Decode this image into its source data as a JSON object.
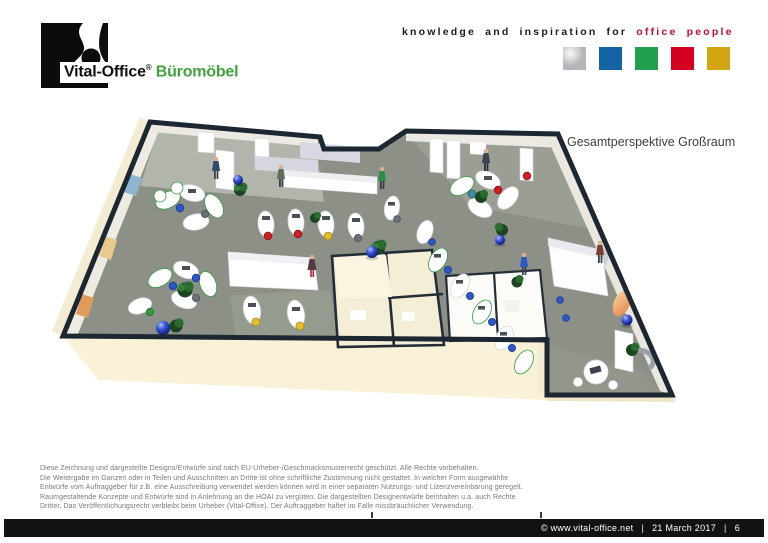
{
  "header": {
    "brand": {
      "name": "Vital-Office",
      "reg": "®",
      "product": "Büromöbel",
      "product_color": "#3fa43c"
    },
    "tagline": {
      "black": "knowledge and inspiration for",
      "red": "office people",
      "red_color": "#c30b2a"
    },
    "squares": [
      {
        "name": "silver",
        "color": "#b4b6b9"
      },
      {
        "name": "blue",
        "color": "#1464a5"
      },
      {
        "name": "green",
        "color": "#22a04d"
      },
      {
        "name": "red",
        "color": "#d60021"
      },
      {
        "name": "gold",
        "color": "#d3a512"
      }
    ]
  },
  "main": {
    "caption": "Gesamtperspektive Großraum"
  },
  "legal": {
    "lines": [
      "Diese Zeichnung und dargestellte Designs/Entwürfe sind nach EU-Urheber-/Geschmacksmusterrecht geschützt. Alle Rechte vorbehalten.",
      "Die Weitergabe im Ganzen oder in Teilen und Ausschnitten an Dritte ist ohne schriftliche Zustimmung nicht gestattet. In welcher Form ausgewählte",
      "Entwürfe vom Auftraggeber für z.B. eine Ausschreibung verwendet werden können wird in einer separaten Nutzungs- und Lizenzvereinbarung geregelt.",
      "Raumgestaltende Konzepte und Entwürfe sind in Anlehnung an die HOAI zu vergüten. Die dargestellten Designentwürfe beinhalten u.a. auch Rechte",
      "Dritter. Das Veröffentlichungsrecht verbleibt beim Urheber (Vital-Office). Der Auftraggeber haftet im Falle missbräuchlicher Verwendung."
    ]
  },
  "footer": {
    "copyright": "© www.vital-office.net",
    "separator": "|",
    "date": "21 March 2017",
    "page": "6"
  }
}
